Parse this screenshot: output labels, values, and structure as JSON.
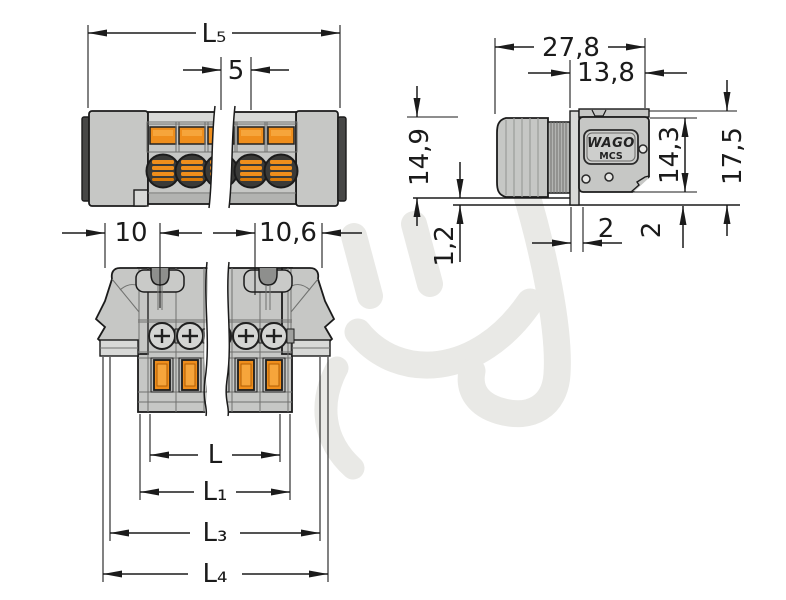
{
  "drawing": {
    "kind": "connector-dimension-drawing",
    "brand": "WAGO",
    "series": "MCS"
  },
  "colors": {
    "line": "#1b1b1b",
    "body": "#c6c7c5",
    "body_light": "#d8d9d7",
    "body_dark": "#9b9c9a",
    "edge_dark": "#474746",
    "contact_orange": "#ef8e1c",
    "contact_orange_light": "#f6a53b",
    "contact_orange_dark": "#b35f05",
    "watermark": "#e9e9e6",
    "background": "#ffffff"
  },
  "dimensions": {
    "top_view": {
      "overall_length": "L₅",
      "pole_pitch": "5"
    },
    "side_view": {
      "depth_total": "27,8",
      "depth_header": "13,8",
      "height_front": "14,9",
      "height_header": "14,3",
      "height_total": "17,5",
      "panel_gap": "1,2",
      "panel_thickness_horizontal": "2",
      "panel_thickness_vertical": "2"
    },
    "front_view": {
      "edge_to_latch": "10",
      "latch_to_lever": "10,6",
      "length": "L",
      "length_1": "L₁",
      "length_3": "L₃",
      "length_4": "L₄"
    }
  }
}
